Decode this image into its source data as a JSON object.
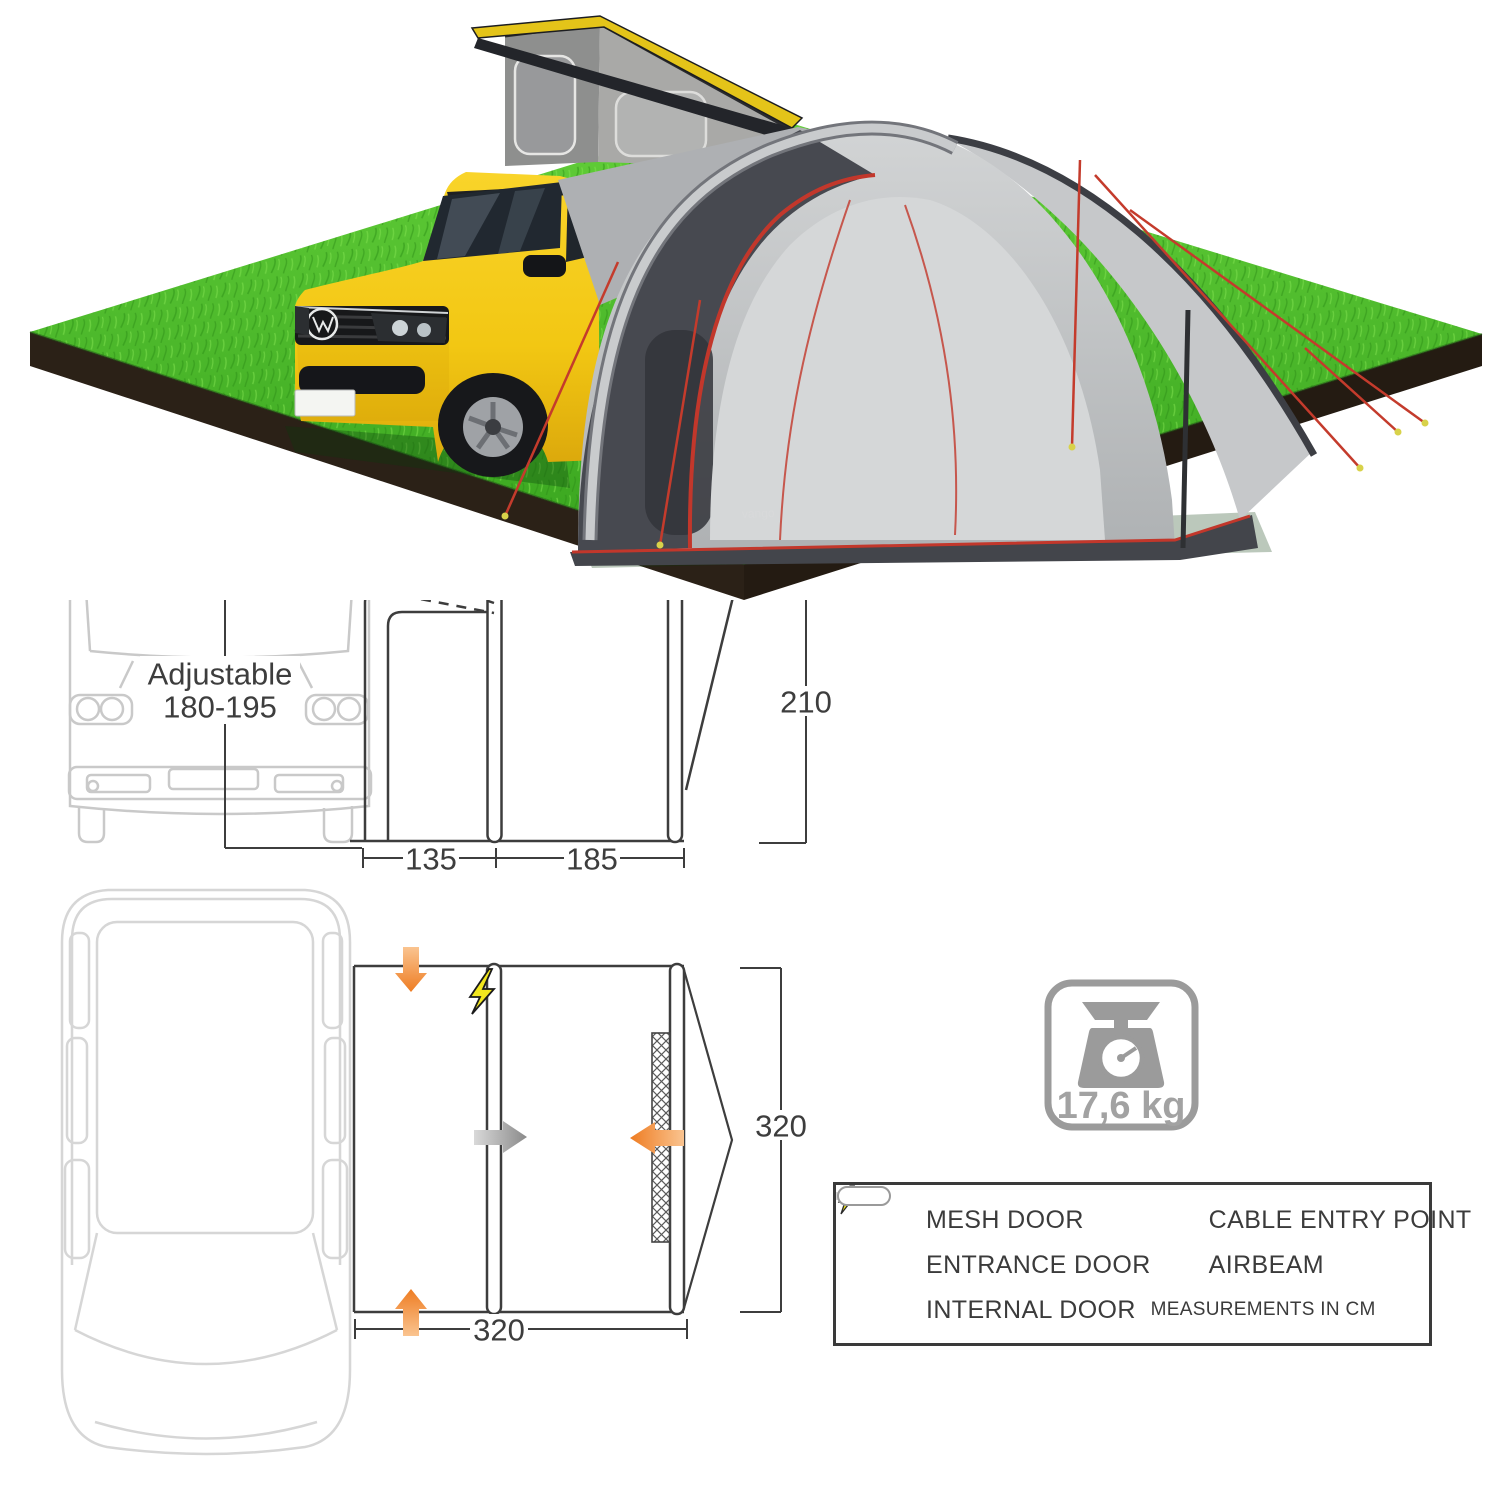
{
  "photo": {
    "description": "yellow camper van with raised pop-top roof and grey drive-away awning on square grass plot",
    "brand_label": "vango"
  },
  "front_diagram": {
    "adjustable_line1": "Adjustable",
    "adjustable_line2": "180-195",
    "dim_left": "135",
    "dim_right": "185",
    "dim_height": "210"
  },
  "floor_plan": {
    "dim_width": "320",
    "dim_depth": "320"
  },
  "weight": {
    "icon": "scale-icon",
    "value": "17,6 kg"
  },
  "legend": {
    "left": [
      {
        "icon": "mesh-door-icon",
        "label": "MESH DOOR"
      },
      {
        "icon": "entrance-door-arrow-icon",
        "label": "ENTRANCE DOOR"
      },
      {
        "icon": "internal-door-arrow-icon",
        "label": "INTERNAL DOOR"
      }
    ],
    "right": [
      {
        "icon": "cable-entry-icon",
        "label": "CABLE ENTRY POINT"
      },
      {
        "icon": "airbeam-icon",
        "label": "AIRBEAM"
      },
      {
        "icon": null,
        "label": "MEASUREMENTS IN CM"
      }
    ]
  },
  "colors": {
    "accent_orange": "#ee7c22",
    "arrow_grey": "#8a8a8a",
    "bolt_yellow": "#f2e71e",
    "grass_green": "#46b525",
    "soil_brown": "#2a2014",
    "van_yellow": "#f2c713",
    "awning_grey": "#c6c8c9",
    "awning_charcoal": "#46484f",
    "trim_red": "#c2372b",
    "line_dark": "#3d3d3d",
    "outline_light_grey": "#cfcfcf",
    "weight_grey": "#9b9b9b"
  }
}
